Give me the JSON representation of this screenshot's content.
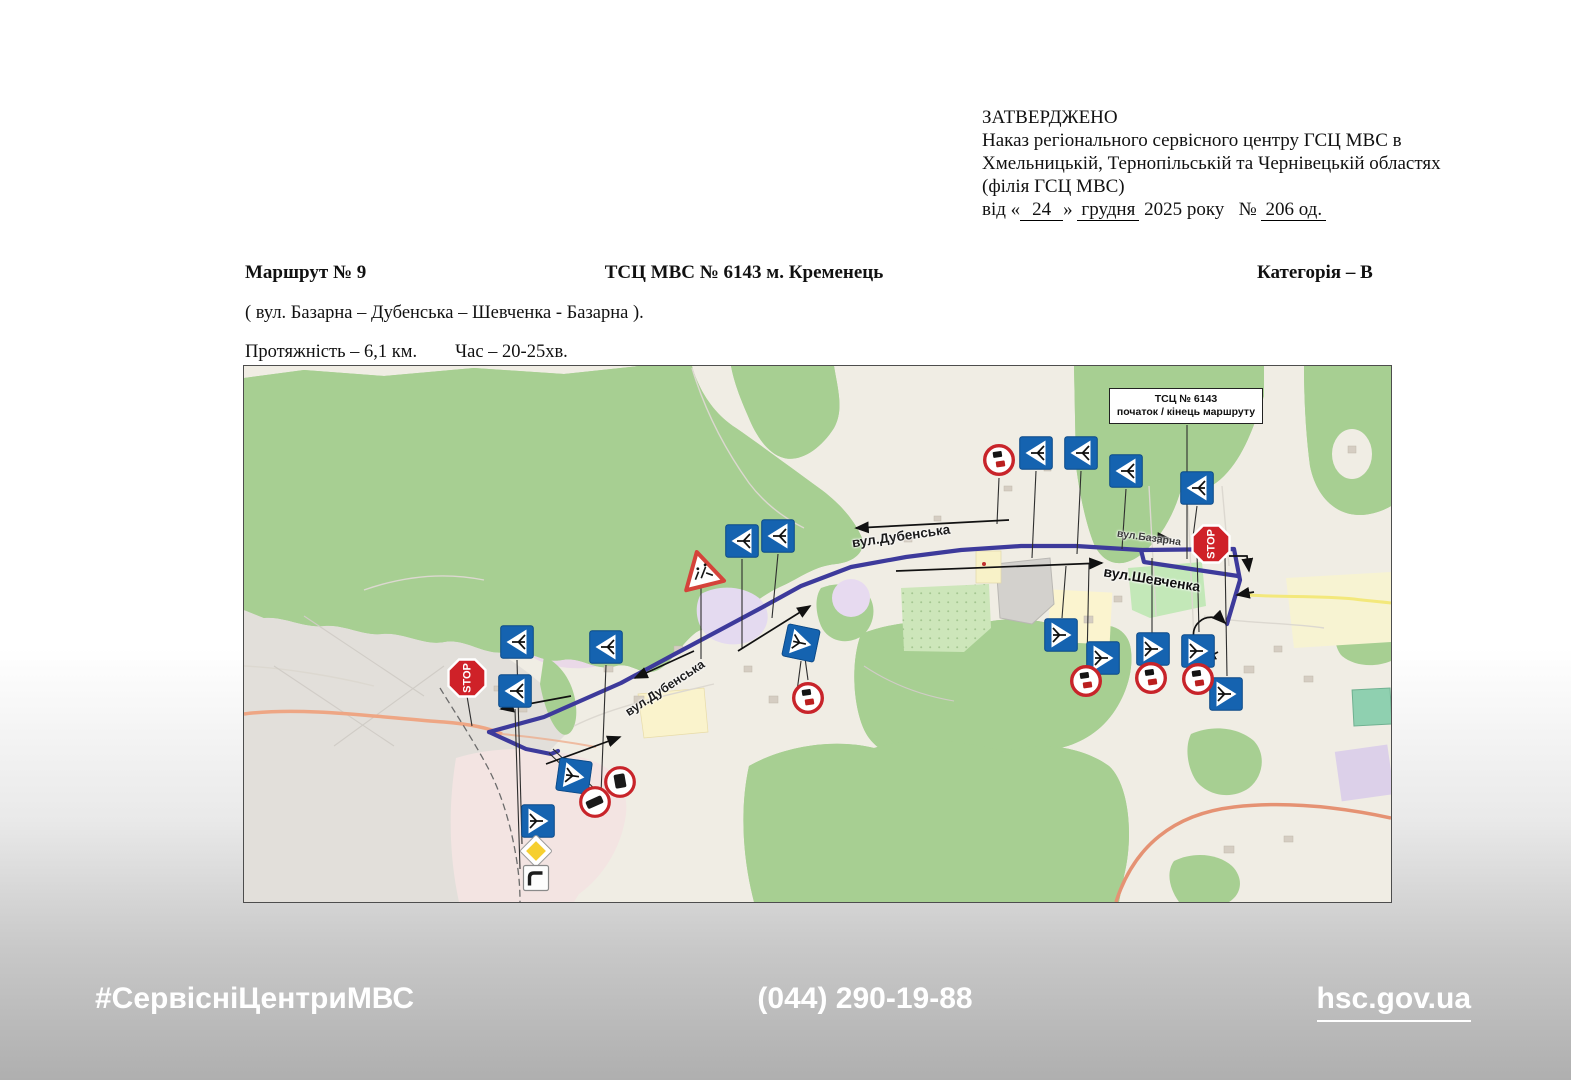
{
  "approval": {
    "line1": "ЗАТВЕРДЖЕНО",
    "line2": "Наказ  регіонального сервісного центру ГСЦ МВС в",
    "line3": "Хмельницькій, Тернопільській та Чернівецькій областях",
    "line4": "(філія ГСЦ МВС)",
    "line5_prefix": "від «",
    "line5_day": "24",
    "line5_close": "»",
    "line5_month": "грудня",
    "line5_year": "2025 року",
    "line5_no": "№",
    "line5_number": "206 од."
  },
  "header": {
    "route_no": "Маршрут № 9",
    "center_title": "ТСЦ МВС № 6143 м. Кременець",
    "category": "Категорія – В",
    "streets_line": "( вул. Базарна – Дубенська – Шевченка - Базарна ).",
    "length_line": "Протяжність – 6,1 км.",
    "time_line": "Час – 20-25хв."
  },
  "map": {
    "callout": {
      "line1": "ТСЦ № 6143",
      "line2": "початок / кінець маршруту"
    },
    "stop_sign_text": "STOP",
    "street_labels": [
      {
        "text": "вул.Дубенська",
        "x": 657,
        "y": 170,
        "rotate": -8,
        "size": 13.5,
        "color": "#1c1c1c"
      },
      {
        "text": "вул.Дубенська",
        "x": 421,
        "y": 322,
        "rotate": -33,
        "size": 12.5,
        "color": "#1c1c1c"
      },
      {
        "text": "вул.Шевченка",
        "x": 908,
        "y": 213,
        "rotate": 9,
        "size": 14,
        "color": "#101010"
      },
      {
        "text": "вул.Базарна",
        "x": 905,
        "y": 172,
        "rotate": 8,
        "size": 10.5,
        "color": "#3a3a3a"
      }
    ],
    "signs": [
      {
        "name": "junction-layout-sign",
        "type": "junction",
        "variant": "L",
        "x": 273,
        "y": 276
      },
      {
        "name": "junction-layout-sign",
        "type": "junction",
        "variant": "L",
        "x": 362,
        "y": 281
      },
      {
        "name": "junction-layout-sign",
        "type": "junction",
        "variant": "L",
        "x": 271,
        "y": 325
      },
      {
        "name": "junction-layout-sign",
        "type": "junction",
        "variant": "R",
        "x": 330,
        "y": 410,
        "rotate": 8
      },
      {
        "name": "junction-layout-sign",
        "type": "junction",
        "variant": "R",
        "x": 294,
        "y": 455
      },
      {
        "name": "junction-layout-sign",
        "type": "junction",
        "variant": "R",
        "x": 557,
        "y": 277,
        "rotate": 12
      },
      {
        "name": "junction-layout-sign",
        "type": "junction",
        "variant": "L",
        "x": 498,
        "y": 175
      },
      {
        "name": "junction-layout-sign",
        "type": "junction",
        "variant": "L",
        "x": 534,
        "y": 170
      },
      {
        "name": "junction-layout-sign",
        "type": "junction",
        "variant": "L",
        "x": 792,
        "y": 87
      },
      {
        "name": "junction-layout-sign",
        "type": "junction",
        "variant": "L",
        "x": 837,
        "y": 87
      },
      {
        "name": "junction-layout-sign",
        "type": "junction",
        "variant": "L",
        "x": 882,
        "y": 105
      },
      {
        "name": "junction-layout-sign",
        "type": "junction",
        "variant": "L",
        "x": 953,
        "y": 122
      },
      {
        "name": "junction-layout-sign",
        "type": "junction",
        "variant": "R",
        "x": 817,
        "y": 269
      },
      {
        "name": "junction-layout-sign",
        "type": "junction",
        "variant": "R",
        "x": 859,
        "y": 292
      },
      {
        "name": "junction-layout-sign",
        "type": "junction",
        "variant": "R",
        "x": 909,
        "y": 283
      },
      {
        "name": "junction-layout-sign",
        "type": "junction",
        "variant": "R",
        "x": 954,
        "y": 285
      },
      {
        "name": "junction-layout-sign",
        "type": "junction",
        "variant": "R",
        "x": 982,
        "y": 328
      },
      {
        "name": "stop-sign",
        "type": "stop",
        "x": 223,
        "y": 312
      },
      {
        "name": "stop-sign",
        "type": "stop",
        "x": 967,
        "y": 178
      },
      {
        "name": "prohibition-sign",
        "type": "circle-bars",
        "x": 755,
        "y": 94
      },
      {
        "name": "prohibition-sign",
        "type": "circle-bars",
        "x": 564,
        "y": 332
      },
      {
        "name": "prohibition-sign",
        "type": "circle-bars",
        "x": 842,
        "y": 315
      },
      {
        "name": "prohibition-sign",
        "type": "circle-bars",
        "x": 907,
        "y": 312
      },
      {
        "name": "prohibition-sign",
        "type": "circle-bars",
        "x": 954,
        "y": 313
      },
      {
        "name": "no-vehicle-sign",
        "type": "circle-vehicle-front",
        "x": 376,
        "y": 416
      },
      {
        "name": "no-vehicle-sign",
        "type": "circle-vehicle-side",
        "x": 351,
        "y": 436
      },
      {
        "name": "warning-triangle-sign",
        "type": "warning",
        "x": 457,
        "y": 203,
        "rotate": -14
      },
      {
        "name": "priority-road-sign",
        "type": "diamond",
        "x": 292,
        "y": 485
      },
      {
        "name": "main-road-direction-sign",
        "type": "mainroad",
        "x": 292,
        "y": 512
      }
    ],
    "colors": {
      "route": "#3d3a9b",
      "sign_blue": "#1563b0",
      "stop_red": "#cf2128",
      "forest_green": "#a7cf92",
      "urban_gray": "#e2dfda",
      "map_base": "#f0ede4"
    }
  },
  "footer": {
    "hashtag": "#СервісніЦентриМВС",
    "phone": "(044) 290-19-88",
    "site": "hsc.gov.ua"
  }
}
